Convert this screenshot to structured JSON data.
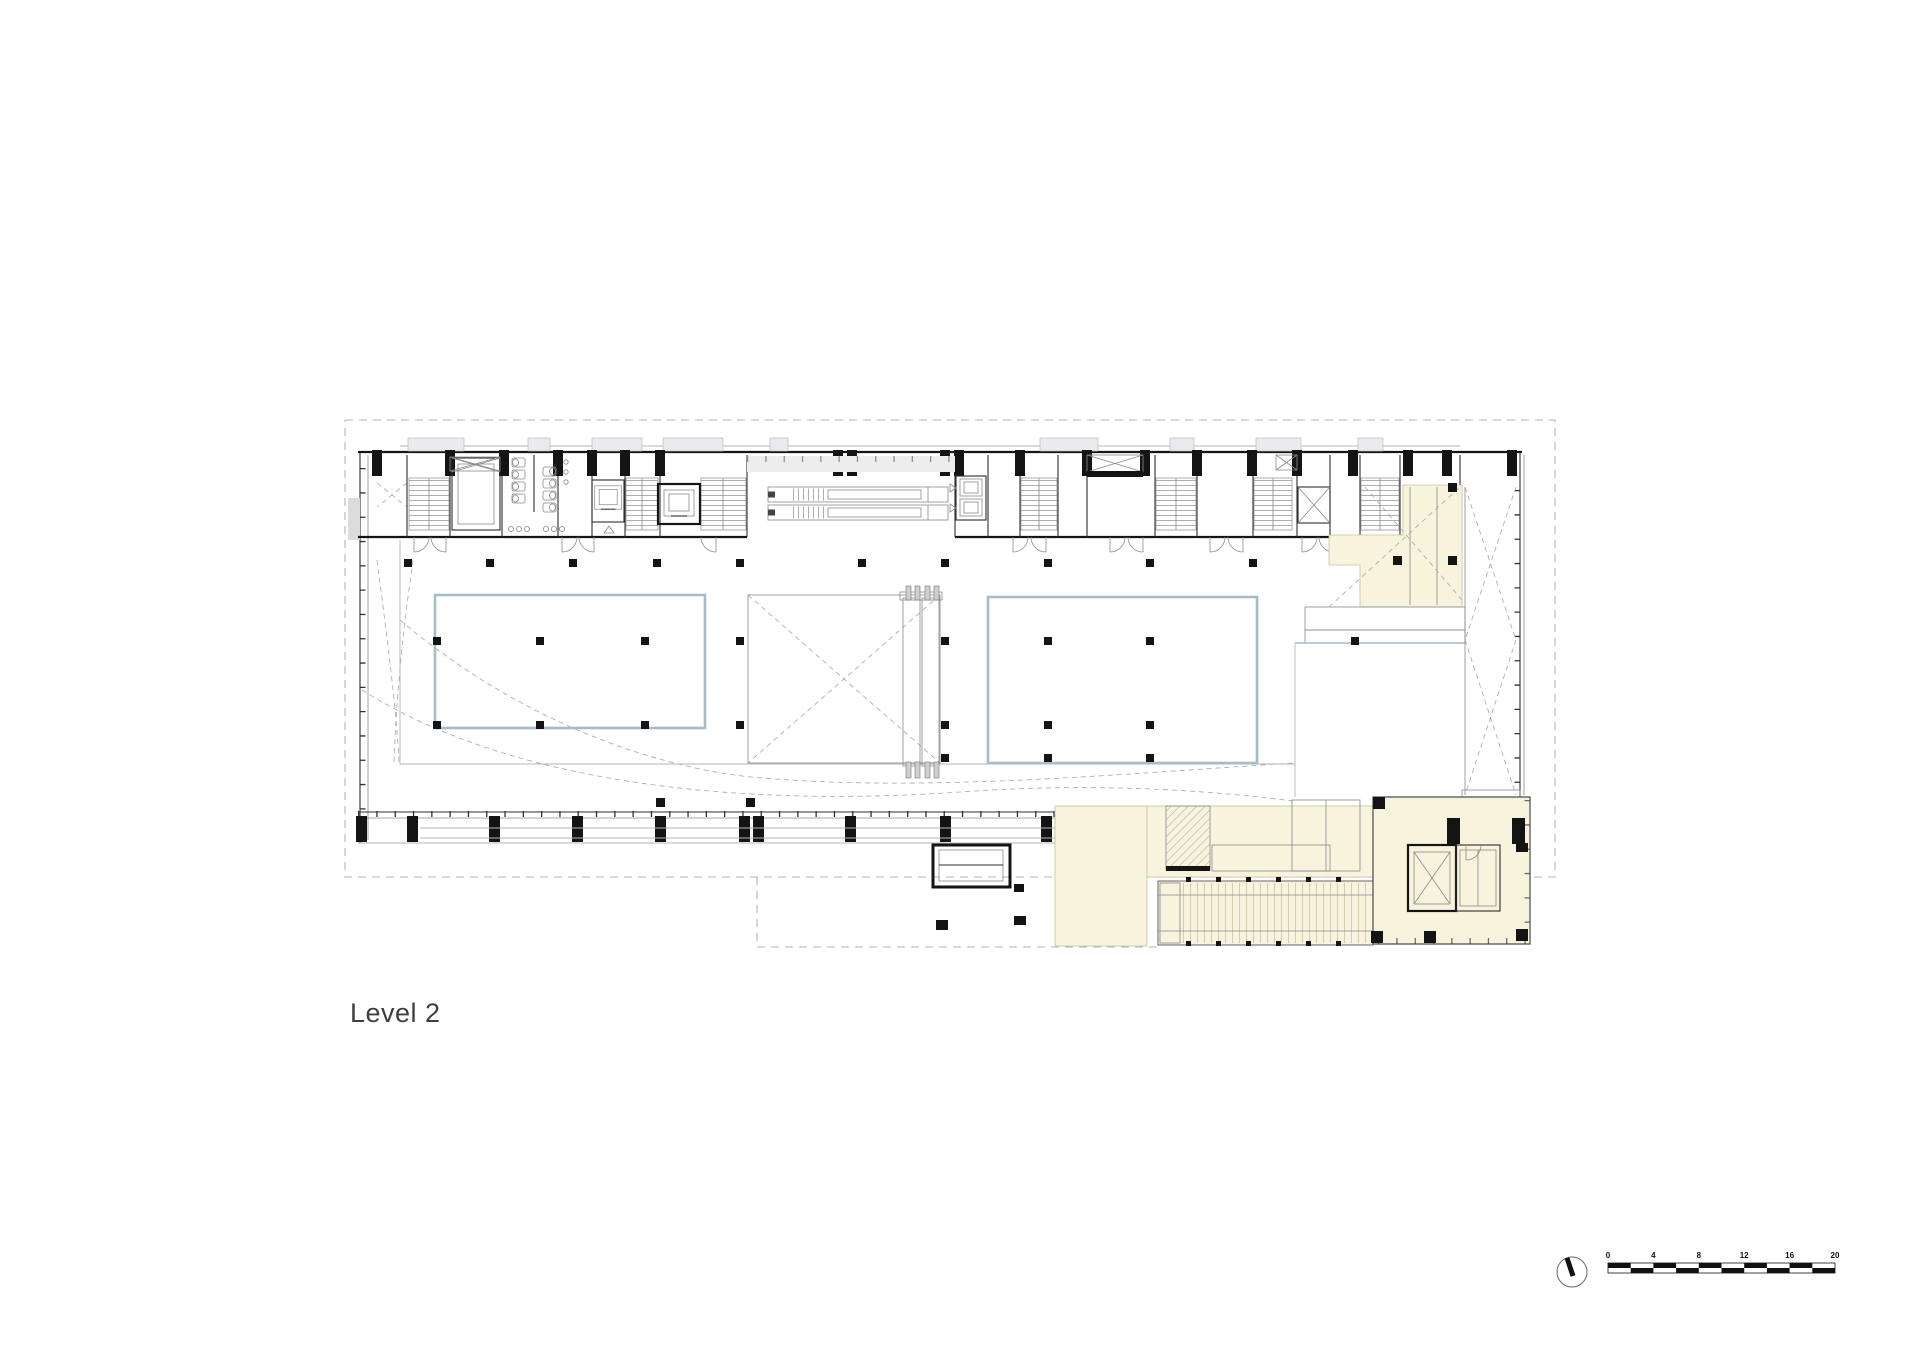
{
  "title": {
    "label": "Level 2"
  },
  "legend": {
    "north_icon": "north-arrow",
    "scale_labels": [
      "0",
      "4",
      "8",
      "12",
      "16",
      "20"
    ]
  },
  "plan": {
    "colors": {
      "cream": "#f7f3dd",
      "hall_outline": "#a7bcc6",
      "wall": "#141414",
      "boundary_dash": "#b3b3b3",
      "canopy": "#e9ebee",
      "paper": "#ffffff"
    }
  }
}
